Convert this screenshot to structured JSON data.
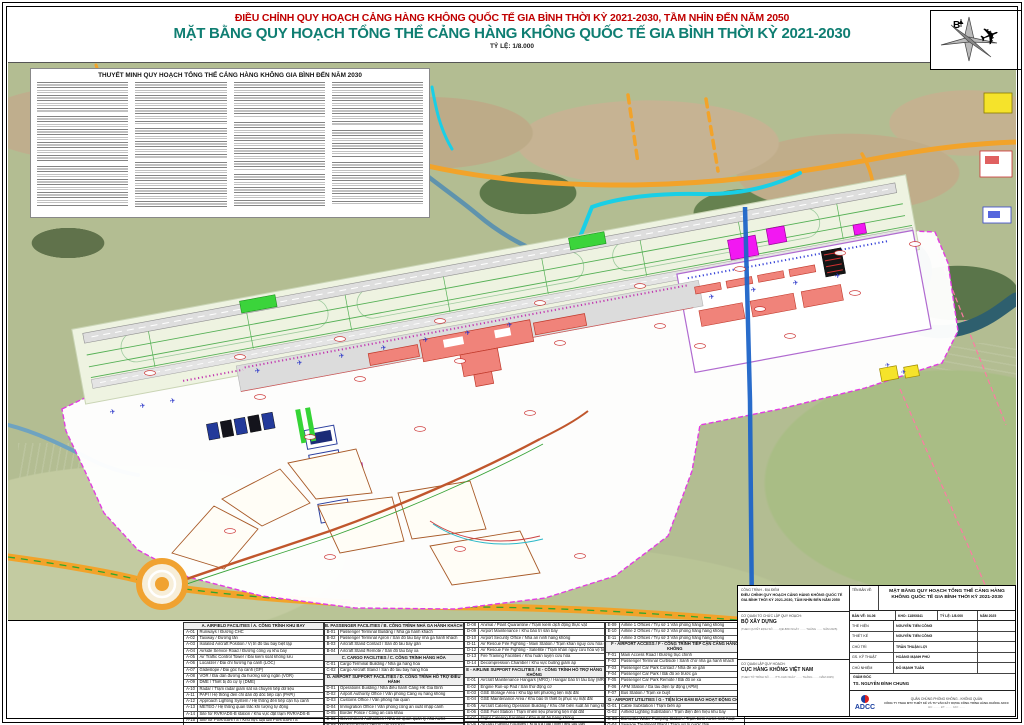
{
  "titles": {
    "line1": "ĐIỀU CHỈNH QUY HOẠCH CẢNG HÀNG KHÔNG QUỐC TẾ GIA BÌNH THỜI KỲ 2021-2030, TẦM NHÌN ĐẾN NĂM 2050",
    "line2": "MẶT BẰNG QUY HOẠCH TỔNG THỂ CẢNG HÀNG KHÔNG QUỐC TẾ GIA BÌNH THỜI KỲ 2021-2030",
    "scale": "TỶ LỆ: 1/8.000"
  },
  "compass": {
    "north_label": "B"
  },
  "notes": {
    "title": "THUYẾT MINH QUY HOẠCH TỔNG THỂ CẢNG HÀNG KHÔNG GIA BÌNH ĐẾN NĂM 2030"
  },
  "legend": {
    "columns": [
      [
        {
          "h": "A. AIRFIELD FACILITIES / A. CÔNG TRÌNH KHU BAY"
        },
        {
          "c": "A-01",
          "t": "Runways / Đường CHC"
        },
        {
          "c": "A-02",
          "t": "Taxiway / Đường lăn"
        },
        {
          "c": "A-03",
          "t": "Isolated Aircraft Position / Vị trí đỗ tàu bay biệt lập"
        },
        {
          "c": "A-04",
          "t": "Airside Service Road / Đường công vụ khu bay"
        },
        {
          "c": "A-05",
          "t": "Air Traffic Control Tower / Đài kiểm soát không lưu"
        },
        {
          "c": "A-06",
          "t": "Localizer / Đài chỉ hướng hạ cánh (LOC)"
        },
        {
          "c": "A-07",
          "t": "Glideslope / Đài góc hạ cánh (GP)"
        },
        {
          "c": "A-08",
          "t": "VOR / Đài dẫn đường đa hướng sóng ngắn (VOR)"
        },
        {
          "c": "A-09",
          "t": "DME / Thiết bị đo cự ly (DME)"
        },
        {
          "c": "A-10",
          "t": "Radar / Trạm radar giám sát và chuyển tiếp dữ liệu"
        },
        {
          "c": "A-11",
          "t": "PAPI / Hệ thống đèn chỉ dẫn độ dốc tiếp cận (PAPI)"
        },
        {
          "c": "A-12",
          "t": "Approach Lighting System / Hệ thống đèn tiếp cận hạ cánh"
        },
        {
          "c": "A-13",
          "t": "METEO / Hệ thống quan trắc khí tượng tự động"
        },
        {
          "c": "A-14",
          "t": "Site for RVR/ADS-B station / Khu vực đặt trạm RVR/ADS-B"
        },
        {
          "c": "A-15",
          "t": "Site for PSR/SSR/TS / Khu vực đặt đài PSR/SSR/TS"
        }
      ],
      [
        {
          "h": "B. PASSENGER FACILITIES / B. CÔNG TRÌNH NHÀ GA HÀNH KHÁCH"
        },
        {
          "c": "B-01",
          "t": "Passenger Terminal Building / Nhà ga hành khách"
        },
        {
          "c": "B-02",
          "t": "Passenger Terminal Apron / Sân đỗ tàu bay nhà ga hành khách"
        },
        {
          "c": "B-03",
          "t": "Aircraft Stand Contact / Sân đỗ tàu bay gần"
        },
        {
          "c": "B-04",
          "t": "Aircraft Stand Remote / Sân đỗ tàu bay xa"
        },
        {
          "h": "C. CARGO FACILITIES / C. CÔNG TRÌNH HÀNG HÓA"
        },
        {
          "c": "C-01",
          "t": "Cargo Terminal Building / Nhà ga hàng hóa"
        },
        {
          "c": "C-02",
          "t": "Cargo Aircraft Stand / Sân đỗ tàu bay hàng hóa"
        },
        {
          "h": "D. AIRPORT SUPPORT FACILITIES / D. CÔNG TRÌNH HỖ TRỢ ĐIỀU HÀNH"
        },
        {
          "c": "D-01",
          "t": "Operations Building / Nhà điều hành Cảng HK Gia Bình"
        },
        {
          "c": "D-02",
          "t": "Airport Authority Office / Văn phòng Cảng vụ hàng không"
        },
        {
          "c": "D-03",
          "t": "Customs Office / Văn phòng hải quan"
        },
        {
          "c": "D-04",
          "t": "Immigration Office / Văn phòng công an xuất nhập cảnh"
        },
        {
          "c": "D-05",
          "t": "Border Police / Công an cửa khẩu"
        },
        {
          "c": "D-06",
          "t": "Government Authorities / Nhà cơ quan quản lý nhà nước"
        },
        {
          "c": "D-07",
          "t": "Medical Center / Trạm y tế sân bay"
        }
      ],
      [
        {
          "c": "D-08",
          "t": "Animal / Plant Quarantine / Trạm kiểm dịch động thực vật"
        },
        {
          "c": "D-09",
          "t": "Airport Maintenance / Khu bảo trì sân bay"
        },
        {
          "c": "D-10",
          "t": "Airport Security Office / Nhà an ninh hàng không"
        },
        {
          "c": "D-11",
          "t": "Air Rescue Fire Fighting - Main Station / Trạm khẩn nguy cứu hỏa chính"
        },
        {
          "c": "D-12",
          "t": "Air Rescue Fire Fighting - Satellite / Trạm khẩn nguy cứu hỏa vệ tinh"
        },
        {
          "c": "D-13",
          "t": "Fire Training Facilities / Khu huấn luyện cứu hỏa"
        },
        {
          "c": "D-14",
          "t": "Decompression Chamber / Khu vực buồng giảm áp"
        },
        {
          "h": "E - AIRLINE SUPPORT FACILITIES / E - CÔNG TRÌNH HỖ TRỢ HÀNG KHÔNG"
        },
        {
          "c": "E-01",
          "t": "Aircraft Maintenance Hangars (MRO) / Hangar bảo trì tàu bay (MRO)"
        },
        {
          "c": "E-02",
          "t": "Engine Run-up Pad / Sân thử động cơ"
        },
        {
          "c": "E-03",
          "t": "GSE Storage Area / Khu tập kết phương tiện mặt đất"
        },
        {
          "c": "E-04",
          "t": "GSE Maintenance Area / Khu bảo trì thiết bị phục vụ mặt đất"
        },
        {
          "c": "E-05",
          "t": "Aircraft Catering Operation Building / Khu chế biến suất ăn hàng không"
        },
        {
          "c": "E-06",
          "t": "GSE Fuel Station / Trạm nhiên liệu phương tiện mặt đất"
        },
        {
          "c": "E-07",
          "t": "Flight Catering Facilities / Khu suất ăn hàng không"
        },
        {
          "c": "E-08",
          "t": "Aircraft Fueling Facilities / Khu tra nạp nhiên liệu tàu bay"
        }
      ],
      [
        {
          "c": "E-09",
          "t": "Airline 1 Offices / Trụ sở 1 Văn phòng hãng hàng không"
        },
        {
          "c": "E-10",
          "t": "Airline 2 Offices / Trụ sở 2 Văn phòng hãng hàng không"
        },
        {
          "c": "E-11",
          "t": "Airline 3 Offices / Trụ sở 3 Văn phòng hãng hàng không"
        },
        {
          "h": "F - AIRPORT ACCESS / F - CÔNG TRÌNH TIẾP CẬN CẢNG HÀNG KHÔNG"
        },
        {
          "c": "F-01",
          "t": "Main Access Road / Đường trục chính"
        },
        {
          "c": "F-02",
          "t": "Passenger Terminal Curbside / Sảnh chờ nhà ga hành khách"
        },
        {
          "c": "F-03",
          "t": "Passenger Car Park Contact / Nhà để xe gần"
        },
        {
          "c": "F-04",
          "t": "Passenger Car Park / Bãi đỗ xe trước ga"
        },
        {
          "c": "F-05",
          "t": "Passenger Car Park Remote / Bãi đỗ xe xa"
        },
        {
          "c": "F-06",
          "t": "APM Station / Ga tàu điện tự động (APM)"
        },
        {
          "c": "F-07",
          "t": "Bus Station / Trạm xe buýt"
        },
        {
          "h": "G - AIRPORT UTILITIES / G - TIỆN ÍCH ĐẢM BẢO HOẠT ĐỘNG CHK"
        },
        {
          "c": "G-01",
          "t": "Cable Substation / Trạm biến áp"
        },
        {
          "c": "G-02",
          "t": "Airfield Lighting Substation / Trạm điện đèn hiệu khu bay"
        },
        {
          "c": "G-03",
          "t": "Domestic Water Pumping Station / Trạm bơm nước sinh hoạt"
        },
        {
          "c": "G-04",
          "t": "Sewage Treatment Plant / Trạm xử lý nước thải"
        }
      ]
    ]
  },
  "titleblock": {
    "project_label": "CÔNG TRÌNH - ĐỊA ĐIỂM",
    "project_name": "ĐIỀU CHỈNH QUY HOẠCH CẢNG HÀNG KHÔNG QUỐC TẾ GIA BÌNH THỜI KỲ 2021-2030, TẦM NHÌN ĐẾN NĂM 2050",
    "org1_label": "CƠ QUAN TỔ CHỨC LẬP QUY HOẠCH:",
    "org1_name": "BỘ XÂY DỰNG",
    "org1_note": "(THEO QUYẾT ĐỊNH SỐ ……/QĐ-BXD NGÀY …… THÁNG …… NĂM 2025)",
    "org2_label": "CƠ QUAN LẬP QUY HOẠCH:",
    "org2_name": "CỤC HÀNG KHÔNG VIỆT NAM",
    "org2_note": "(THEO TỜ TRÌNH SỐ ……/TTr-CHK NGÀY …… THÁNG …… NĂM 2025)",
    "drawing_label": "TÊN BẢN VẼ:",
    "drawing_name": "MẶT BẰNG QUY HOẠCH TỔNG THỂ CẢNG HÀNG KHÔNG QUỐC TẾ GIA BÌNH THỜI KỲ 2021-2030",
    "meta": {
      "sheet": "BẢN VẼ: 04-06",
      "size": "KHỔ: 1189X841",
      "scale": "TỶ LỆ: 1/8.000",
      "year": "NĂM 2025"
    },
    "roles": [
      {
        "label": "THỂ HIỆN",
        "name": "NGUYỄN TIẾN CÔNG"
      },
      {
        "label": "THIẾT KẾ",
        "name": "NGUYỄN TIẾN CÔNG"
      },
      {
        "label": "CHỦ TRÌ",
        "name": "TRẦN THUẬN LỢI"
      },
      {
        "label": "GS. KỸ THUẬT",
        "name": "HOÀNG MẠNH PHÚ"
      },
      {
        "label": "CHỦ NHIỆM",
        "name": "ĐỖ MẠNH TUẤN"
      }
    ],
    "director_label": "GIÁM ĐỐC",
    "director_name": "TS. NGUYỄN ĐÌNH CHUNG",
    "company_line1": "QUÂN CHỦNG PHÒNG KHÔNG - KHÔNG QUÂN",
    "company_line2": "CÔNG TY TNHH MTV THIẾT KẾ VÀ TƯ VẤN XÂY DỰNG CÔNG TRÌNH HÀNG KHÔNG ADCC",
    "company_line3": "ĐC: …… · ĐT: …… · FAX: ……",
    "logo_text": "ADCC"
  },
  "colors": {
    "title_red": "#c00000",
    "title_teal": "#0f7e72",
    "boundary_magenta": "#e23ce2",
    "road_orange": "#f2a32a",
    "terminal_red": "#f0837a",
    "water_cyan": "#19cfe6"
  }
}
